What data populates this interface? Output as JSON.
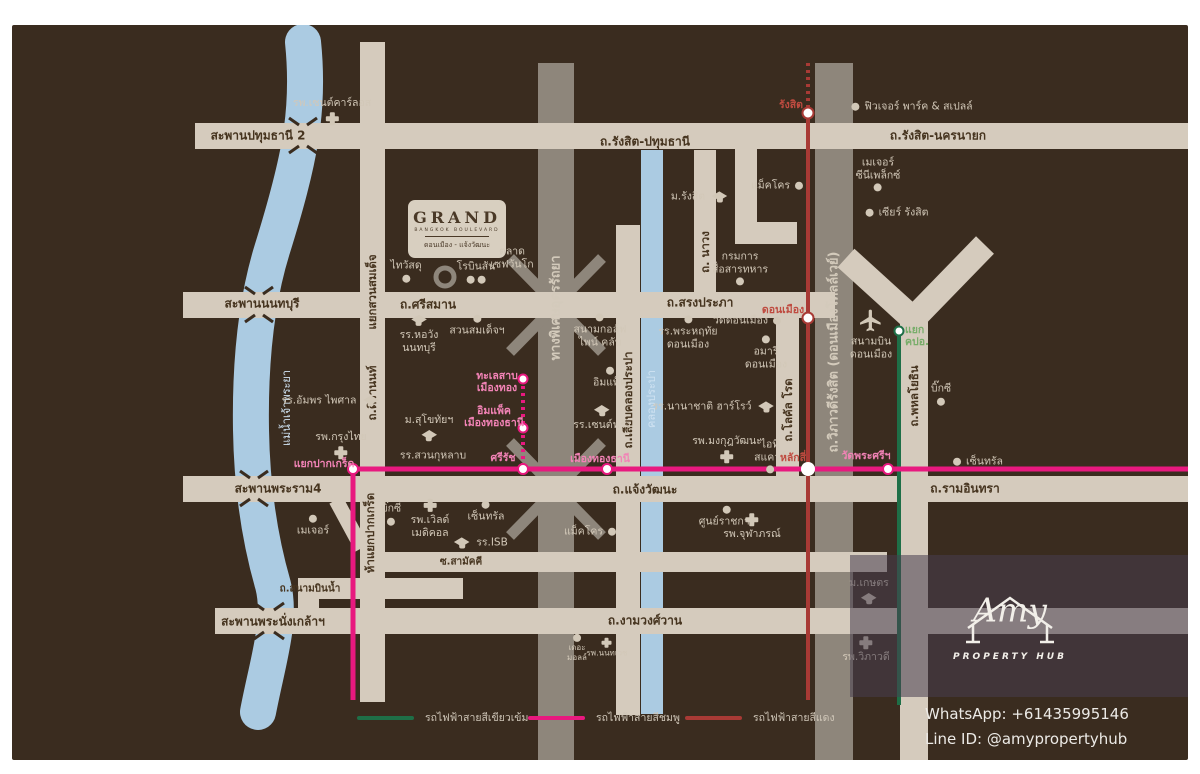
{
  "brand_card": {
    "name": "GRAND",
    "subtitle": "BANGKOK BOULEVARD",
    "tagline": "ดอนเมือง - แจ้งวัฒนะ"
  },
  "roads": {
    "pathumthani2": "สะพานปทุมธานี 2",
    "rangsit_pathumthani": "ถ.รังสิต-ปทุมธานี",
    "rangsit_nakhonnayok": "ถ.รังสิต-นครนายก",
    "srisaman": "ถ.ศรีสมาน",
    "nonthaburi_bridge": "สะพานนนทบุรี",
    "songprapha": "ถ.สรงประภา",
    "chaengwatthana": "ถ.แจ้งวัฒนะ",
    "rama4_bridge": "สะพานพระราม4",
    "ramindra": "ถ.รามอินทรา",
    "samakkhi": "ซ.สามัคคี",
    "sanambin_nam": "ถ.สนามบินน้ำ",
    "ngamwongwan": "ถ.งามวงศ์วาน",
    "phranangklao_bridge": "สะพานพระนั่งเกล้าฯ",
    "yaek_suan_somdet": "แยกสวนสมเด็จ",
    "tiwanon": "ถ.ติวานนท์",
    "hayaek_pakkret": "ห้าแยกปากเกร็ด",
    "navong": "ถ. นาวง",
    "liab_klong_prapa": "ถ.เลียบคลองประปา",
    "local_road": "ถ.โลคัล โรด",
    "phahonyothin": "ถ.พหลโยธิน",
    "udon_ratthaya": "ทางพิเศษอุดรรัถยา",
    "vibhavadi_tollway": "ถ.วิภาวดีรังสิต (ดอนเมืองโทลล์เวย์)"
  },
  "waterways": {
    "chao_phraya": "แม่น้ำเจ้าพระยา",
    "klong_prapa": "คลองประปา"
  },
  "pois": {
    "st_carlos": "รพ.เซนต์คาร์ลอส",
    "future_park": "ฟิวเจอร์ พาร์ค & สเปลล์",
    "major_cineplex": "เมเจอร์\nซีนีเพล็กซ์",
    "zeer_rangsit": "เซียร์ รังสิต",
    "m_rangsit": "ม.รังสิต",
    "makro_top": "แม็คโคร",
    "military_comm": "กรมการ\nสื่อสารทหาร",
    "thai_watsadu": "ไทวัสดุ",
    "robinson": "โรบินสัน",
    "save_one_go": "ตลาด\nเซฟวันโก",
    "horwang": "รร.หอวัง\nนนทบุรี",
    "suan_somdet": "สวนสมเด็จฯ",
    "pine_golf": "สนามกอล์ฟ\nไพน์ คลับ",
    "impact": "อิมแพ็ค",
    "st_francis": "รร.เซนต์ฟรัง",
    "phra_haruethai": "รร.พระหฤทัย\nดอนเมือง",
    "wat_donmueang": "วัดดอนเมือง",
    "amari": "อมารี\nดอนเมือง",
    "donmueang_airport": "สนามบิน\nดอนเมือง",
    "big_c_right": "บิ๊กซี",
    "amphorn": "รร.อัมพร\nไพศาล",
    "krungthai": "รพ.กรุงไทย",
    "sukhothai": "ม.สุโขทัยฯ",
    "suan_kularb": "รร.สวนกุหลาบ",
    "harrow": "รร.นานาชาติ ฮาร์โรว์",
    "mongkut": "รพ.มงกุฎวัฒนะ",
    "it_square": "ไอที\nสแควร์",
    "central_right": "เซ็นทรัล",
    "central_left": "เซ็นทรัล",
    "major_left": "เมเจอร์",
    "big_c_left": "บิ๊กซี",
    "world_medical": "รพ.เวิลด์\nเมดิคอล",
    "isb": "รร.ISB",
    "govt_center": "ศูนย์ราชการ",
    "chulabhorn": "รพ.จุฬาภรณ์",
    "makro_bottom": "แม็คโคร",
    "the_mall": "เดอะ\nมอลล์",
    "nonthavej": "รพ.นนทเวช",
    "kasetsart": "ม.เกษตร",
    "vibhavadi_hosp": "รพ.วิภาวดี"
  },
  "stations": {
    "rangsit": "รังสิต",
    "don_mueang": "ดอนเมือง",
    "lak_si": "หลักสี่",
    "pak_kret": "แยกปากเกร็ด",
    "si_rat": "ศรีรัช",
    "mueang_thong_thani": "เมืองทองธานี",
    "lake_mueang_thong": "ทะเลสาบ\nเมืองทอง",
    "impact_mueang_thong": "อิมแพ็ค\nเมืองทองธานี",
    "wat_phra_si": "วัดพระศรีฯ",
    "yaek_kpo": "แยก\nคปอ."
  },
  "legend": {
    "items": [
      {
        "label": "รถไฟฟ้าสายสีเขียวเข้ม",
        "color": "#1e6f47"
      },
      {
        "label": "รถไฟฟ้าสายสีชมพู",
        "color": "#e8197f"
      },
      {
        "label": "รถไฟฟ้าสายสีแดง",
        "color": "#a83a35"
      }
    ]
  },
  "watermark": {
    "name": "Amy",
    "subtitle": "PROPERTY HUB"
  },
  "contact": {
    "whatsapp": "WhatsApp: +61435995146",
    "line_id": "Line ID: @amypropertyhub"
  },
  "colors": {
    "background": "#3a2c1f",
    "road": "#d5cbbd",
    "expressway": "#8e867b",
    "water": "#abcbe2",
    "pink_line": "#e8197f",
    "red_line": "#a83a35",
    "green_line": "#1e6f47",
    "label_text": "#d2c8b8"
  }
}
